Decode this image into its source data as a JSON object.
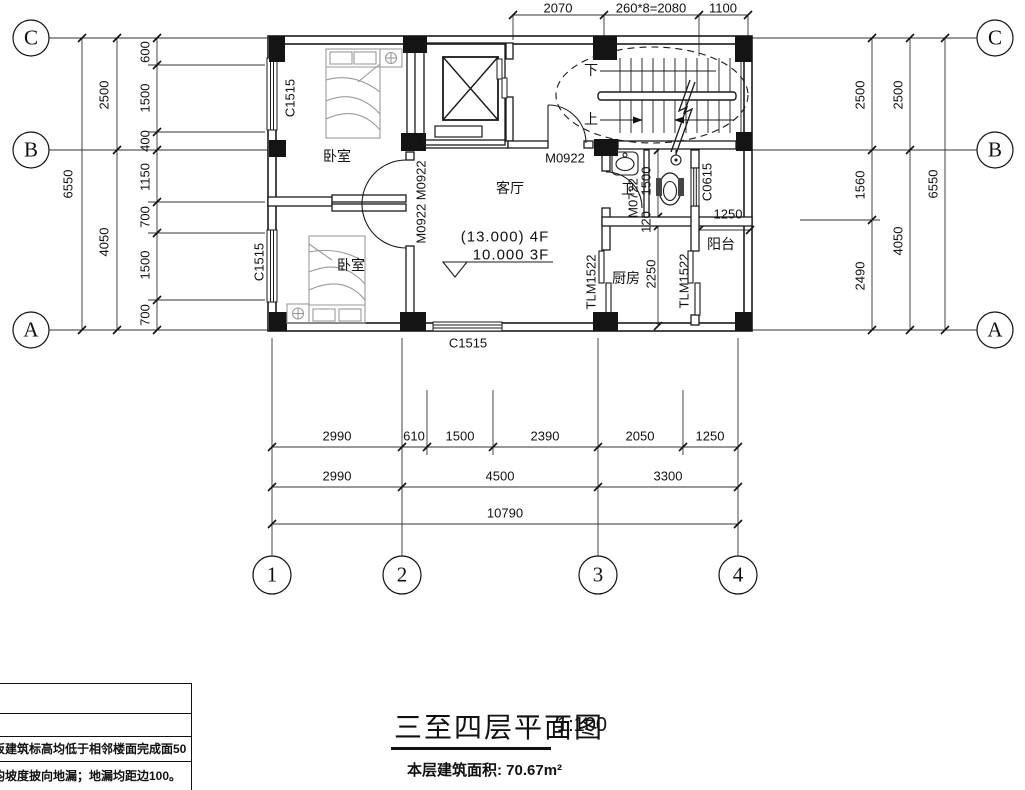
{
  "title_block": {
    "title": "三至四层平面图",
    "scale": "1:100",
    "area": "本层建筑面积: 70.67m²"
  },
  "notes_table": {
    "row1": "板建筑标高均低于相邻楼面完成面50",
    "row2": "均坡度披向地漏；地漏均距边100。"
  },
  "grid": {
    "rows": [
      "C",
      "B",
      "A"
    ],
    "cols": [
      "1",
      "2",
      "3",
      "4"
    ]
  },
  "rooms": {
    "bedroom_top": "卧室",
    "bedroom_bottom": "卧室",
    "living": "客厅",
    "bathroom": "卫",
    "kitchen": "厨房",
    "balcony": "阳台"
  },
  "stair": {
    "down": "下",
    "up": "上"
  },
  "levels": {
    "upper": "(13.000) 4F",
    "lower": "10.000  3F"
  },
  "openings": {
    "c1515_left_top": "C1515",
    "c1515_left_bottom": "C1515",
    "c1515_bottom": "C1515",
    "c0615": "C0615",
    "m0922_hall": "M0922",
    "m0922_pair": "M0922 M0922",
    "m0722": "M0722",
    "tlm1522_a": "TLM1522",
    "tlm1522_b": "TLM1522"
  },
  "dims": {
    "top": [
      "2070",
      "260*8=2080",
      "1100"
    ],
    "left_outer": "6550",
    "left_mid": [
      "2500",
      "4050"
    ],
    "left_inner": [
      "600",
      "1500",
      "400",
      "1150",
      "700",
      "1500",
      "700"
    ],
    "right_inner": [
      "2500",
      "1560",
      "2490"
    ],
    "right_mid": [
      "2500",
      "4050"
    ],
    "right_outer": "6550",
    "bottom_row1": [
      "2990",
      "610",
      "1500",
      "2390",
      "2050",
      "1250"
    ],
    "bottom_row2": [
      "2990",
      "4500",
      "3300"
    ],
    "bottom_row3": "10790",
    "bath_height": "1500",
    "bath_wall": "120",
    "kitchen_depth": "2250",
    "balcony_width": "1250"
  }
}
